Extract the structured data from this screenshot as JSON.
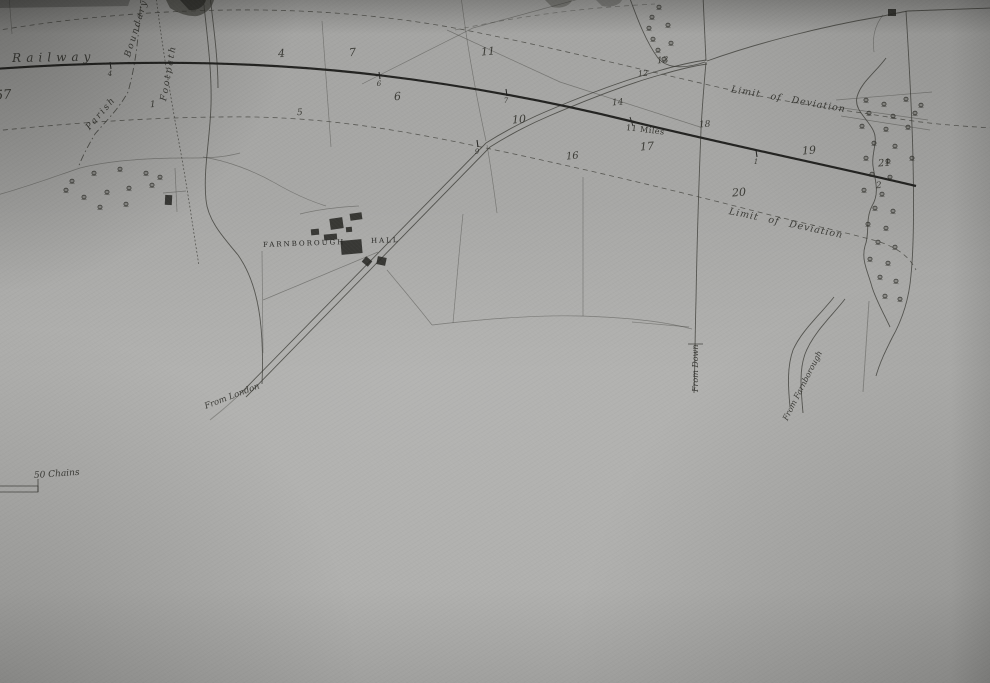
{
  "map": {
    "labels": {
      "railway": "Railway",
      "parish": "Parish",
      "boundary": "Boundary",
      "footpath": "Footpath",
      "limit_of_deviation_upper": "Limit of Deviation",
      "limit_of_deviation_lower": "Limit of Deviation",
      "miles": "11 Miles",
      "estate_name": "FARNBOROUGH",
      "estate_name_2": "HALL",
      "road_from_london": "From London",
      "road_from_down": "From Down",
      "road_from_farnborough": "From Farnborough",
      "scale": "50 Chains"
    },
    "parcel_numbers": [
      {
        "value": "57",
        "x": -5,
        "y": 88,
        "size": 13
      },
      {
        "value": "1",
        "x": 150,
        "y": 100,
        "size": 9
      },
      {
        "value": "4",
        "x": 278,
        "y": 47,
        "size": 11
      },
      {
        "value": "7",
        "x": 349,
        "y": 46,
        "size": 11
      },
      {
        "value": "11",
        "x": 481,
        "y": 45,
        "size": 11
      },
      {
        "value": "5",
        "x": 297,
        "y": 108,
        "size": 9
      },
      {
        "value": "6",
        "x": 394,
        "y": 90,
        "size": 11
      },
      {
        "value": "10",
        "x": 512,
        "y": 113,
        "size": 11
      },
      {
        "value": "12",
        "x": 638,
        "y": 69,
        "size": 8
      },
      {
        "value": "13",
        "x": 657,
        "y": 56,
        "size": 9
      },
      {
        "value": "14",
        "x": 612,
        "y": 98,
        "size": 9
      },
      {
        "value": "16",
        "x": 566,
        "y": 151,
        "size": 10
      },
      {
        "value": "17",
        "x": 640,
        "y": 140,
        "size": 11
      },
      {
        "value": "18",
        "x": 699,
        "y": 120,
        "size": 9
      },
      {
        "value": "19",
        "x": 802,
        "y": 144,
        "size": 11
      },
      {
        "value": "20",
        "x": 732,
        "y": 186,
        "size": 11
      },
      {
        "value": "21",
        "x": 878,
        "y": 158,
        "size": 10
      },
      {
        "value": "2",
        "x": 876,
        "y": 181,
        "size": 9
      }
    ],
    "railway_markers": [
      {
        "value": "4",
        "x": 110,
        "y": 66
      },
      {
        "value": "6",
        "x": 379,
        "y": 76
      },
      {
        "value": "7",
        "x": 506,
        "y": 93
      },
      {
        "value": "9",
        "x": 477,
        "y": 144
      },
      {
        "value": "1",
        "x": 756,
        "y": 154
      }
    ],
    "trees": [
      [
        66,
        190
      ],
      [
        72,
        181
      ],
      [
        94,
        173
      ],
      [
        120,
        169
      ],
      [
        146,
        173
      ],
      [
        160,
        177
      ],
      [
        84,
        197
      ],
      [
        107,
        192
      ],
      [
        129,
        188
      ],
      [
        152,
        185
      ],
      [
        100,
        207
      ],
      [
        126,
        204
      ],
      [
        659,
        7
      ],
      [
        652,
        17
      ],
      [
        649,
        28
      ],
      [
        653,
        39
      ],
      [
        658,
        50
      ],
      [
        664,
        59
      ],
      [
        668,
        25
      ],
      [
        671,
        43
      ],
      [
        866,
        100
      ],
      [
        884,
        104
      ],
      [
        906,
        99
      ],
      [
        921,
        105
      ],
      [
        869,
        113
      ],
      [
        893,
        116
      ],
      [
        915,
        113
      ],
      [
        862,
        126
      ],
      [
        886,
        129
      ],
      [
        908,
        127
      ],
      [
        874,
        143
      ],
      [
        895,
        146
      ],
      [
        912,
        158
      ],
      [
        866,
        158
      ],
      [
        888,
        161
      ],
      [
        872,
        174
      ],
      [
        890,
        177
      ],
      [
        864,
        190
      ],
      [
        882,
        194
      ],
      [
        875,
        208
      ],
      [
        893,
        211
      ],
      [
        868,
        224
      ],
      [
        886,
        228
      ],
      [
        878,
        242
      ],
      [
        895,
        247
      ],
      [
        870,
        259
      ],
      [
        888,
        263
      ],
      [
        880,
        277
      ],
      [
        896,
        281
      ],
      [
        885,
        296
      ],
      [
        900,
        299
      ]
    ],
    "buildings": [
      {
        "x": 330,
        "y": 218,
        "w": 13,
        "h": 11,
        "r": -8
      },
      {
        "x": 350,
        "y": 213,
        "w": 12,
        "h": 7,
        "r": -8
      },
      {
        "x": 324,
        "y": 234,
        "w": 13,
        "h": 6,
        "r": -5
      },
      {
        "x": 341,
        "y": 240,
        "w": 21,
        "h": 14,
        "r": -5
      },
      {
        "x": 311,
        "y": 229,
        "w": 8,
        "h": 6,
        "r": -5
      },
      {
        "x": 346,
        "y": 227,
        "w": 6,
        "h": 5,
        "r": -5
      },
      {
        "x": 363,
        "y": 258,
        "w": 8,
        "h": 7,
        "r": 40
      },
      {
        "x": 377,
        "y": 257,
        "w": 9,
        "h": 8,
        "r": 12
      },
      {
        "x": 165,
        "y": 195,
        "w": 7,
        "h": 10,
        "r": 3
      },
      {
        "x": 888,
        "y": 9,
        "w": 8,
        "h": 7,
        "r": 0
      }
    ],
    "colors": {
      "paper": "#adadab",
      "railway_ink": "#232321",
      "road_ink": "#3f3f3c",
      "faint_ink": "#6f6f6a",
      "text_ink": "#2f2f2b"
    }
  }
}
